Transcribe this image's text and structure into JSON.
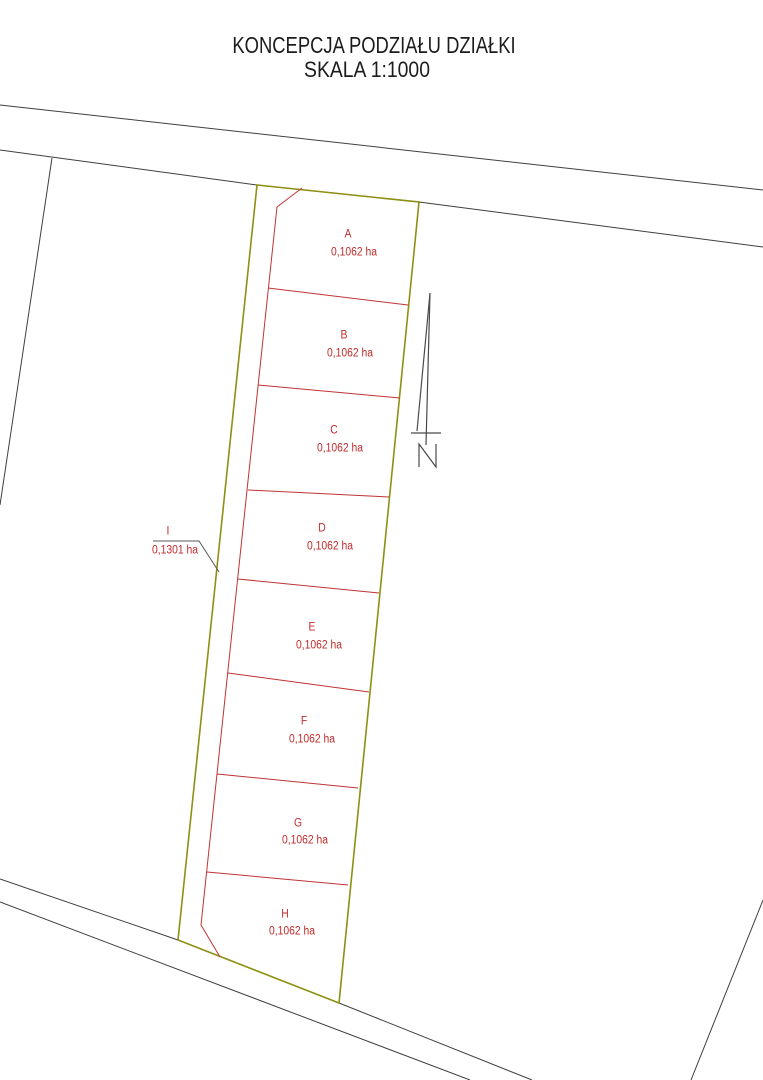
{
  "title": {
    "line1": "KONCEPCJA PODZIAŁU DZIAŁKI",
    "line2": "SKALA 1:1000"
  },
  "north_label": "N",
  "colors": {
    "background": "#ffffff",
    "boundary_line": "#3f3f3f",
    "parcel_outline": "#8f8f12",
    "division_line": "#c03333",
    "label_text": "#c22a2a",
    "leader_line": "#5a5a5a",
    "north_arrow": "#4a4a4a",
    "title_text": "#1c1c1c"
  },
  "parcels": [
    {
      "id": "A",
      "area": "0,1062 ha",
      "letter_pos": [
        348,
        235
      ],
      "area_pos": [
        354,
        253
      ]
    },
    {
      "id": "B",
      "area": "0,1062 ha",
      "letter_pos": [
        344,
        336
      ],
      "area_pos": [
        350,
        354
      ]
    },
    {
      "id": "C",
      "area": "0,1062 ha",
      "letter_pos": [
        334,
        431
      ],
      "area_pos": [
        340,
        449
      ]
    },
    {
      "id": "D",
      "area": "0,1062 ha",
      "letter_pos": [
        322,
        529
      ],
      "area_pos": [
        330,
        547
      ]
    },
    {
      "id": "E",
      "area": "0,1062 ha",
      "letter_pos": [
        312,
        628
      ],
      "area_pos": [
        319,
        646
      ]
    },
    {
      "id": "F",
      "area": "0,1062 ha",
      "letter_pos": [
        304,
        722
      ],
      "area_pos": [
        312,
        740
      ]
    },
    {
      "id": "G",
      "area": "0,1062 ha",
      "letter_pos": [
        298,
        824
      ],
      "area_pos": [
        305,
        841
      ]
    },
    {
      "id": "H",
      "area": "0,1062 ha",
      "letter_pos": [
        285,
        915
      ],
      "area_pos": [
        292,
        932
      ]
    },
    {
      "id": "I",
      "area": "0,1301 ha",
      "letter_pos": [
        168,
        532
      ],
      "area_pos": [
        175,
        551
      ]
    }
  ],
  "geometry": {
    "canvas": [
      763,
      1080
    ],
    "parcel_outline": {
      "name": "parcel-outline",
      "closed": true,
      "points": [
        [
          257,
          185
        ],
        [
          419,
          202
        ],
        [
          339,
          1003
        ],
        [
          178,
          940
        ]
      ]
    },
    "boundary_lines": [
      {
        "name": "road-north-upper-edge",
        "points": [
          [
            0,
            105
          ],
          [
            763,
            190
          ]
        ]
      },
      {
        "name": "road-north-lower-edge",
        "points": [
          [
            0,
            150
          ],
          [
            257,
            185
          ],
          [
            419,
            202
          ],
          [
            763,
            247
          ]
        ]
      },
      {
        "name": "west-neighbor-boundary",
        "points": [
          [
            52,
            158
          ],
          [
            0,
            505
          ]
        ]
      },
      {
        "name": "road-south-upper-edge",
        "points": [
          [
            0,
            879
          ],
          [
            178,
            940
          ],
          [
            339,
            1003
          ],
          [
            532,
            1080
          ]
        ]
      },
      {
        "name": "road-south-lower-edge",
        "points": [
          [
            0,
            902
          ],
          [
            470,
            1080
          ]
        ]
      },
      {
        "name": "southeast-boundary",
        "points": [
          [
            763,
            900
          ],
          [
            691,
            1080
          ]
        ]
      }
    ],
    "division_lines": [
      {
        "name": "strip-i-line",
        "points": [
          [
            302,
            188
          ],
          [
            277,
            207
          ],
          [
            201,
            925
          ],
          [
            220,
            957
          ]
        ]
      },
      {
        "name": "divider-a-b",
        "points": [
          [
            268,
            288
          ],
          [
            408,
            305
          ]
        ]
      },
      {
        "name": "divider-b-c",
        "points": [
          [
            258,
            385
          ],
          [
            400,
            398
          ]
        ]
      },
      {
        "name": "divider-c-d",
        "points": [
          [
            248,
            490
          ],
          [
            389,
            497
          ]
        ]
      },
      {
        "name": "divider-d-e",
        "points": [
          [
            238,
            579
          ],
          [
            379,
            593
          ]
        ]
      },
      {
        "name": "divider-e-f",
        "points": [
          [
            228,
            673
          ],
          [
            369,
            692
          ]
        ]
      },
      {
        "name": "divider-f-g",
        "points": [
          [
            217,
            774
          ],
          [
            358,
            788
          ]
        ]
      },
      {
        "name": "divider-g-h",
        "points": [
          [
            207,
            872
          ],
          [
            348,
            885
          ]
        ]
      }
    ],
    "leader_line": {
      "name": "parcel-i-leader",
      "points": [
        [
          153,
          541
        ],
        [
          199,
          541
        ],
        [
          219,
          572
        ]
      ]
    },
    "north_arrow": {
      "lines": [
        {
          "name": "north-arrow-slant-edge",
          "points": [
            [
              430,
              293
            ],
            [
              417,
              431
            ]
          ]
        },
        {
          "name": "north-arrow-shaft",
          "points": [
            [
              430,
              293
            ],
            [
              426,
              445
            ]
          ]
        },
        {
          "name": "north-arrow-base",
          "points": [
            [
              411,
              433
            ],
            [
              441,
              433
            ]
          ]
        },
        {
          "name": "north-label-n",
          "points": [
            [
              419,
              467
            ],
            [
              419,
              444
            ],
            [
              436,
              467
            ],
            [
              436,
              444
            ]
          ]
        }
      ]
    }
  }
}
